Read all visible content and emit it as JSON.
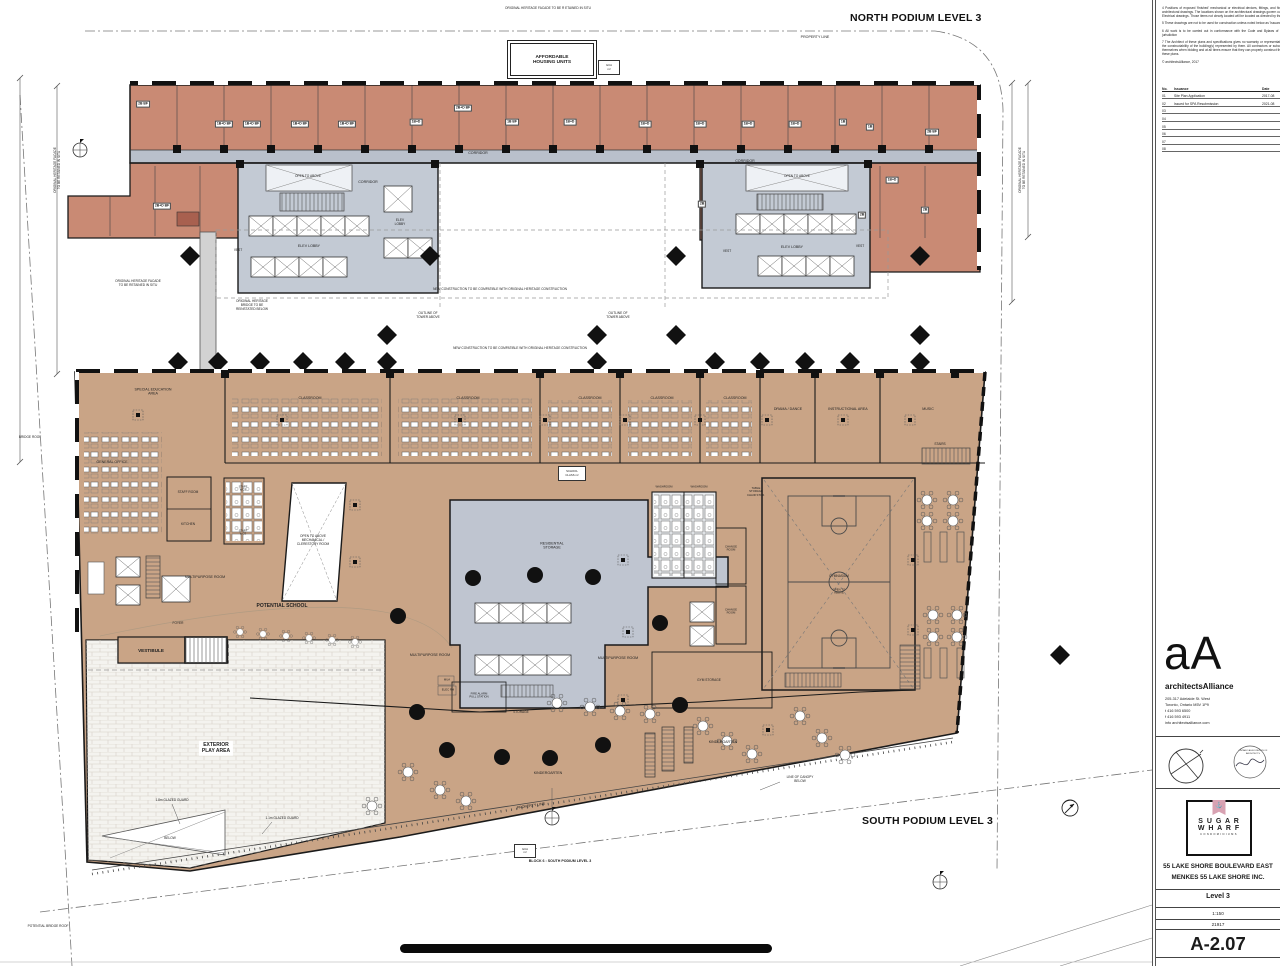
{
  "colors": {
    "salmon": "#c98a74",
    "tan": "#c9a486",
    "core": "#c3cad4",
    "corridor": "#b9c0cb",
    "storage": "#bfc5d0",
    "pink": "#d8a2b2",
    "wall": "#1a1a1a"
  },
  "sheet": {
    "north_title": "NORTH PODIUM LEVEL 3",
    "south_title": "SOUTH PODIUM LEVEL 3",
    "block_caption": "BLOCK 6 : SOUTH PODIUM LEVEL 3",
    "property_line": "PROPERTY LINE",
    "affordable": "AFFORDABLE\nHOUSING UNITS",
    "gca": "GCA\nm²",
    "heritage_top": "ORIGINAL HERITAGE FACADE TO BE R ETAINED IN SITU",
    "heritage_left": "ORIGINAL HERITAGE FACADE\nTO BE RETAINED IN SITU",
    "heritage_bridge": "ORIGINAL HERITAGE\nBRIDGE TO BE\nREINSTATED BELOW",
    "new_construction": "NEW CONSTRUCTION TO BE COMPATIBLE WITH ORIGINAL HERITAGE CONSTRUCTION",
    "outline_tower": "OUTLINE OF\nTOWER ABOVE",
    "bridge_roof": "BRIDGE ROOF",
    "potential_bridge_roof": "POTENTIAL BRIDGE ROOF",
    "line_of_canopy": "LINE OF CANOPY\nBELOW",
    "glazed_18": "1.8m GLAZED GUARD",
    "glazed_11": "1.1m GLAZED GUARD",
    "below": "BELOW"
  },
  "north": {
    "corridor": "CORRIDOR",
    "elev_lobby1": "ELEV LOBBY",
    "elev_lobby": "ELEV\nLOBBY",
    "vest": "VEST",
    "open_above": "OPEN TO ABOVE",
    "units_top": [
      "2B BF",
      "1B+D BF",
      "1B+D BF",
      "1B+D BF",
      "1B+D BF",
      "1B+D",
      "2B+D BF",
      "1B BF",
      "1B+D",
      "1B+D",
      "1B+D",
      "1B+D",
      "1B+D",
      "1B",
      "1B",
      "2B BF"
    ],
    "units_low": [
      "2B+D BF",
      "2B",
      "2B",
      "2B",
      "1B+D"
    ]
  },
  "south": {
    "special_ed": "SPECIAL EDUCATION\nAREA",
    "classroom": "CLASSROOM",
    "drama": "DRAMA / DANCE",
    "instructional": "INSTRUCTIONAL AREA",
    "music": "MUSIC",
    "stairs": "STAIRS",
    "general_office": "GENERAL OFFICE",
    "staff_room": "STAFF ROOM",
    "kitchen": "KITCHEN",
    "staff_wcs": "STAFF\nWCS",
    "mech": "OPEN TO ABOVE\nMECHANICAL /\nCLERESTORY ROOM",
    "multipurpose": "MULTIPURPOSE ROOM",
    "potential_school": "POTENTIAL SCHOOL",
    "foyer": "FOYER",
    "vestibule": "VESTIBULE",
    "kindergarten": "KINDERGARTEN",
    "res_storage": "RESIDENTIAL\nSTORAGE",
    "storage": "STORAGE",
    "gym_storage": "GYM STORAGE",
    "washroom": "WASHROOM",
    "change_room": "CHANGE\nROOM",
    "table_storage": "TABLE\nSTORAGE\nCHAIR STOR.",
    "gymnasium": "GYMNASIUM",
    "open_above": "OPEN TO\nABOVE",
    "fire_alarm": "FIRE ALARM\nPULL STATION",
    "mua": "MUA",
    "elec": "ELEC RM",
    "school_class": "SCHOOL\nCLASS m²",
    "exterior_play": "EXTERIOR\nPLAY AREA"
  },
  "titleblock": {
    "notes": [
      "4  Positions of exposed 'finished' mechanical or electrical devices, fittings, and fixtures are indicated on architectural drawings. The locations shown on the architectural drawings govern over the Mechanical and Electrical drawings. Those items not clearly located will be located as directed by the Architect.",
      "5  These drawings are not to be used for construction unless noted below as 'Issuance for Construction'",
      "6  All work is to be carried out in conformance with the Code and Bylaws of the authorities having jurisdiction",
      "7  The Architect of these plans and specifications gives no warranty or representation to any party about the constructability of the building(s) represented by them. All contractors or subcontractors must satisfy themselves when bidding and at all times ensure that they can properly construct the work represented by these plans.",
      "© architectsAlliance, 2017"
    ],
    "issuance_headers": [
      "No.",
      "Issuance",
      "Date"
    ],
    "issuance_rows": [
      [
        "01",
        "Site Plan Application",
        "2017-08"
      ],
      [
        "02",
        "Issued for SPA Resubmission",
        "2021-08"
      ],
      [
        "03",
        "",
        ""
      ],
      [
        "04",
        "",
        ""
      ],
      [
        "05",
        "",
        ""
      ],
      [
        "06",
        "",
        ""
      ],
      [
        "07",
        "",
        ""
      ],
      [
        "08",
        "",
        ""
      ]
    ],
    "firm_logo": "aA",
    "firm_name": "architectsAlliance",
    "firm_address": "205-317 Adelaide St. West\nToronto, Ontario M5V 1P9\nt 416 593 6500\nf 416 593 4911\ninfo architectsalliance.com",
    "seal_text": "ONTARIO ASSOCIATION OF ARCHITECTS",
    "brand_line1": "S U G A R",
    "brand_line2": "W H A R F",
    "brand_line3": "CONDOMINIUMS",
    "anchor_icon": "⚓",
    "project_line1": "55 LAKE SHORE BOULEVARD EAST",
    "project_line2": "MENKES 55 LAKE SHORE INC.",
    "sheet_title": "Level 3",
    "scale": "1:150",
    "project_no": "21917",
    "sheet_no": "A-2.07"
  }
}
